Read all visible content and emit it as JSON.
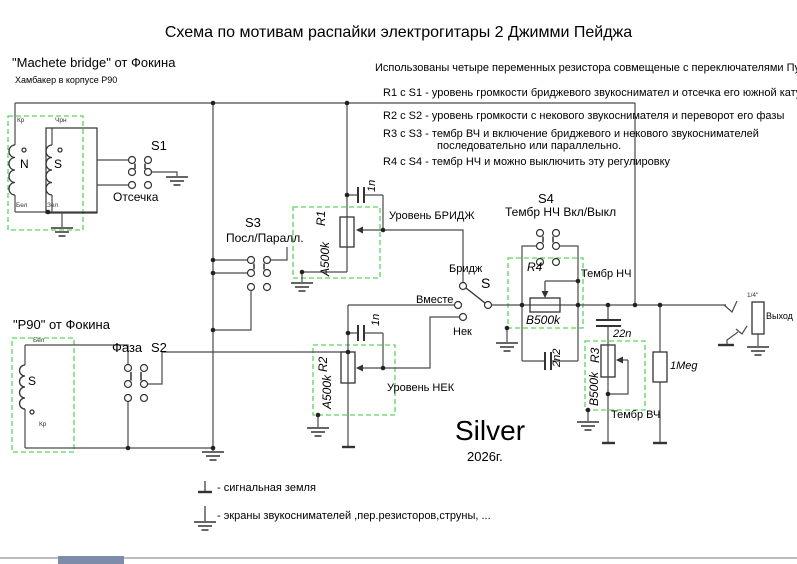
{
  "title": "Схема по мотивам распайки электрогитары 2 Джимми Пейджа",
  "notes": {
    "intro": "Использованы четыре переменных резистора совмещеные с переключателями Пуш-Пул",
    "r1": "R1 с S1 - уровень громкости бриджевого звукоснимател и отсечка его южной  катушки .",
    "r2": "R2 с S2 - уровень громкости с некового звукоснимателя  и переворот его фазы",
    "r3a": "R3 с S3 - тембр ВЧ и включение бриджевого и некового звукоснимателей",
    "r3b": "последовательно или параллельно.",
    "r4": "R4 с S4 - тембр НЧ  и можно выключить эту регулировку"
  },
  "bridge_pickup": {
    "title": "\"Machete bridge\" от Фокина",
    "subtitle": "Хамбакер в корпусе  P90",
    "wire_top_left": "Кр",
    "wire_top_right": "Чрн",
    "wire_bottom_left": "Бел",
    "wire_bottom_right": "Зел",
    "coil_north": "N",
    "coil_south": "S"
  },
  "neck_pickup": {
    "title": "\"P90\" от  Фокина",
    "wire_top": "Бел",
    "wire_bottom": "Кр",
    "coil": "S"
  },
  "switches": {
    "s1": {
      "name": "S1",
      "label": "Отсечка"
    },
    "s2": {
      "name": "S2",
      "label": "Фаза"
    },
    "s3": {
      "name": "S3",
      "label": "Посл/Паралл."
    },
    "s4": {
      "name": "S4",
      "label": "Тембр НЧ Вкл/Выкл"
    }
  },
  "selector": {
    "name": "S",
    "bridge": "Бридж",
    "both": "Вместе",
    "neck": "Нек"
  },
  "pots": {
    "r1": {
      "name": "R1",
      "value": "A500k",
      "cap": "1n",
      "label": "Уровень БРИДЖ"
    },
    "r2": {
      "name": "R2",
      "value": "A500k",
      "cap": "1n",
      "label": "Уровень НЕК"
    },
    "r3": {
      "name": "R3",
      "value": "B500k",
      "cap": "22n",
      "label": "Тембр ВЧ"
    },
    "r4": {
      "name": "R4",
      "value": "B500k",
      "cap": "2n2",
      "label": "Тембр НЧ"
    }
  },
  "load_resistor": "1Meg",
  "output": {
    "jack": "1/4\"",
    "label": "Выход"
  },
  "signature": {
    "name": "Silver",
    "year": "2026г."
  },
  "legend": {
    "signal": "- сигнальная земля",
    "shield": "- экраны звукоснимателей ,пер.резисторов,струны, ..."
  },
  "colors": {
    "box_green": "#5fd35f",
    "wire": "#4a4a4a",
    "component": "#333333"
  }
}
